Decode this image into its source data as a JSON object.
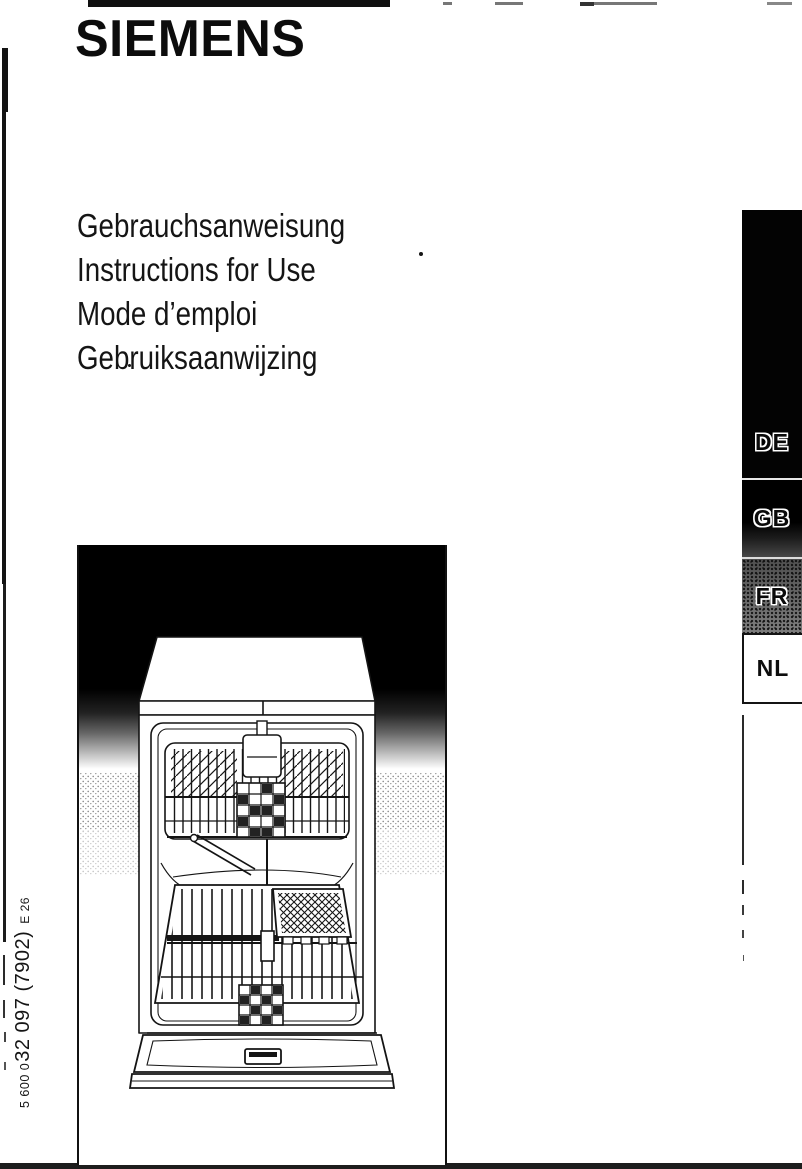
{
  "brand": "SIEMENS",
  "cover_titles": [
    "Gebrauchsanweisung",
    "Instructions for Use",
    "Mode d’emploi",
    "Gebruiksaanwijzing"
  ],
  "language_tabs": [
    {
      "label": "DE"
    },
    {
      "label": "GB"
    },
    {
      "label": "FR"
    },
    {
      "label": "NL"
    }
  ],
  "order_code": {
    "prefix": "5 600 0",
    "main": "32 097 (7902)",
    "suffix": "E 26"
  },
  "illustration": {
    "name": "dishwasher-front-open-line-art"
  },
  "colors": {
    "ink": "#111111",
    "paper": "#ffffff",
    "tab_black": "#030303",
    "tab_gray": "#6f6f6f"
  }
}
